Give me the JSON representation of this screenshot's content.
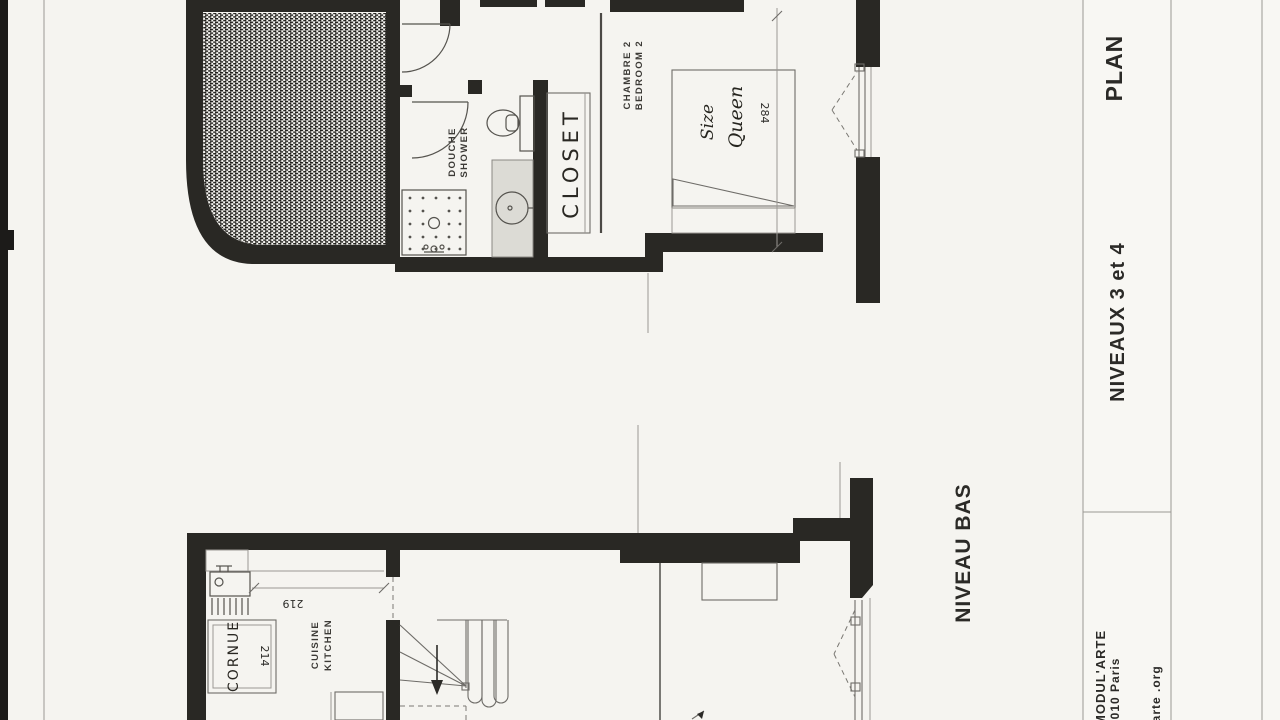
{
  "sheet": {
    "titleblock": {
      "plan_title": "PLAN",
      "levels_label": "NIVEAUX  3  et  4",
      "level_low_label": "NIVEAU BAS",
      "firm_name": "MODUL'ARTE",
      "firm_address": "5010 Paris",
      "firm_website": "ularte .org"
    },
    "upper_plan": {
      "bedroom_label_fr": "CHAMBRE 2",
      "bedroom_label_en": "BEDROOM 2",
      "shower_label_fr": "DOUCHE",
      "shower_label_en": "SHOWER",
      "closet_note": "CLOSET",
      "bed_note_line1": "Queen",
      "bed_note_line2": "Size",
      "bed_dimension_cm": "284"
    },
    "lower_plan": {
      "kitchen_label_fr": "CUISINE",
      "kitchen_label_en": "KITCHEN",
      "range_note": "CORNUE",
      "kitchen_dimension_cm": "219",
      "range_dimension_cm": "214"
    }
  }
}
